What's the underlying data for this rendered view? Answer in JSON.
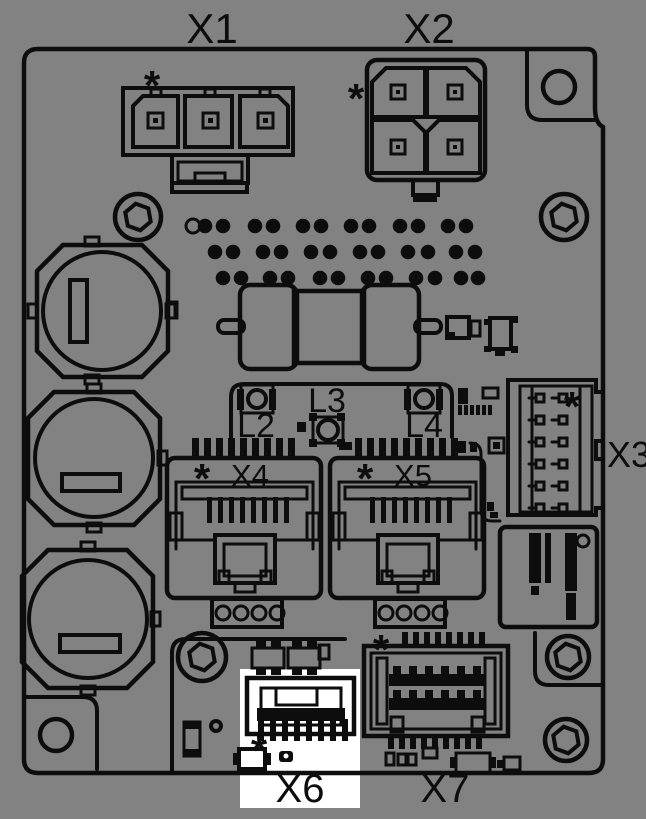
{
  "board": {
    "background_color": "#828282",
    "line_color": "#0d0d0d",
    "highlight_color": "#ffffff",
    "highlighted_connector": "X6",
    "pin1_marker": "*",
    "connectors": {
      "x1": "X1",
      "x2": "X2",
      "x3": "X3",
      "x4": "X4",
      "x5": "X5",
      "x6": "X6",
      "x7": "X7"
    },
    "leds": {
      "l2": "L2",
      "l3": "L3",
      "l4": "L4"
    }
  }
}
